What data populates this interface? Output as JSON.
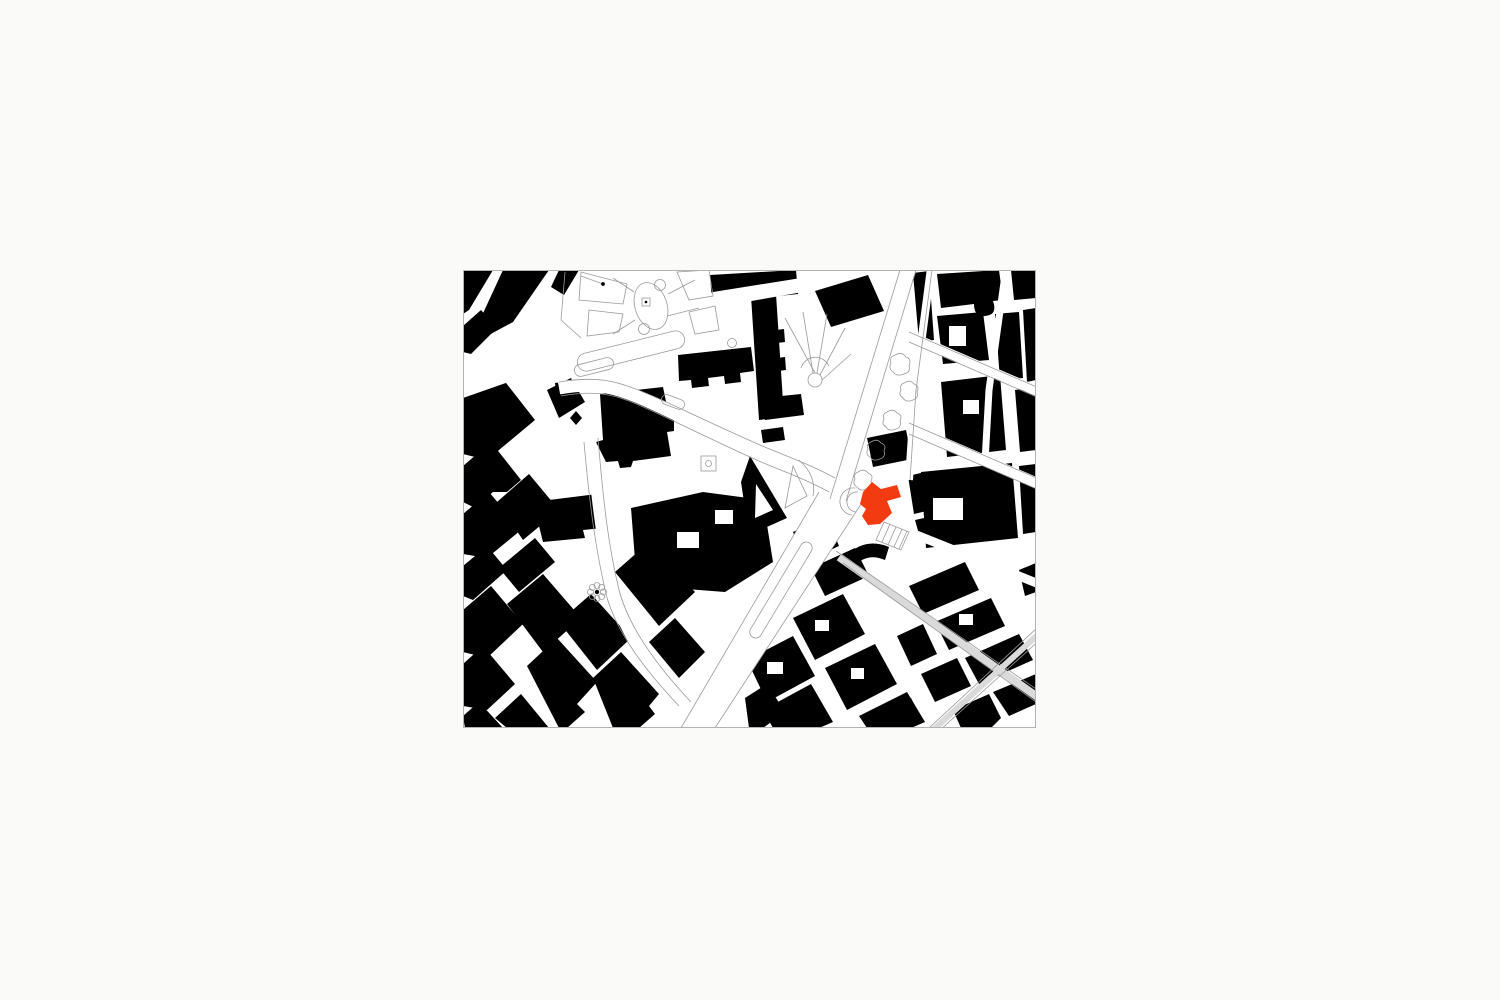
{
  "page": {
    "background_color": "#fafaf8"
  },
  "figure": {
    "kind": "figure-ground-site-plan",
    "description": "black and white urban figure-ground map with highlighted site building",
    "colors": {
      "page": "#fafaf8",
      "mapbg": "#ffffff",
      "building": "#000000",
      "line": "#9a9a9a",
      "track": "#dadada",
      "frame": "#b3b3b3",
      "site": "#f23b10"
    }
  }
}
